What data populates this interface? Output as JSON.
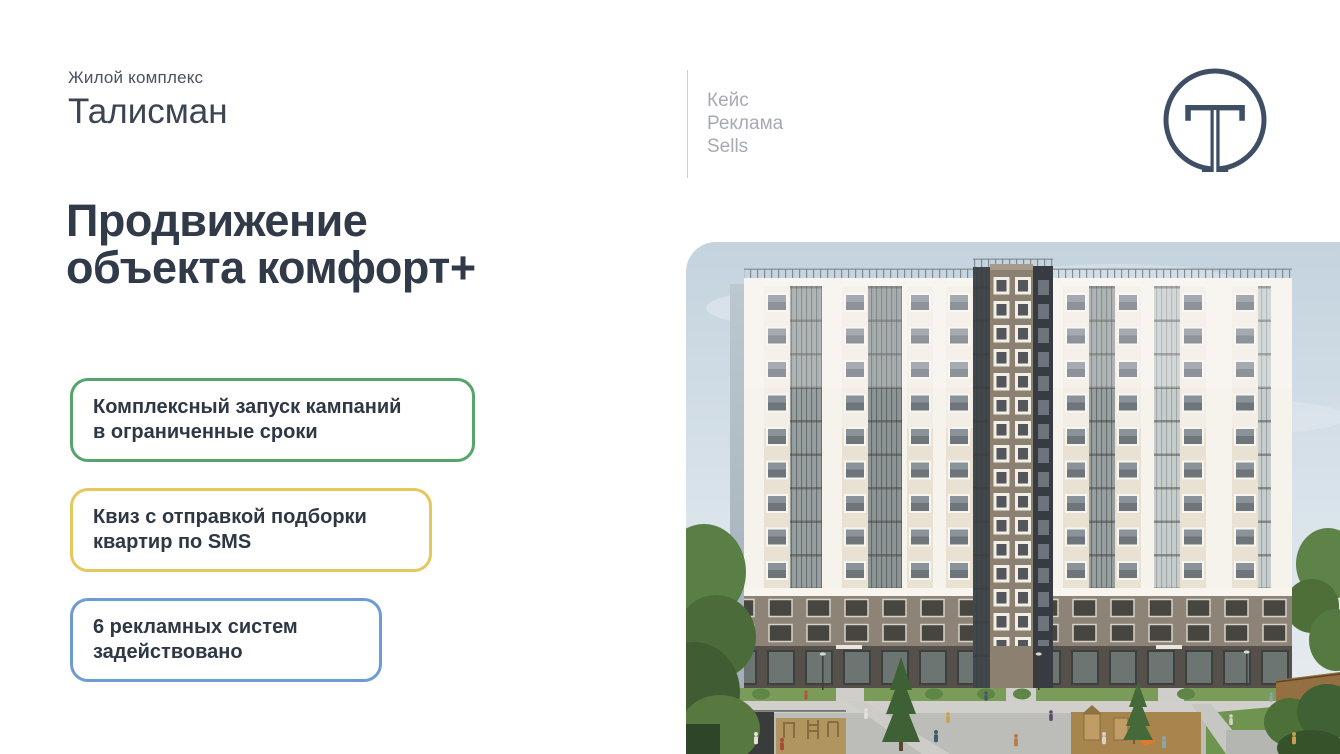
{
  "brand": {
    "label": "Жилой комплекс",
    "name": "Талисман"
  },
  "headline": "Продвижение\nобъекта комфорт+",
  "features": [
    {
      "text": "Комплексный запуск кампаний\nв ограниченные сроки",
      "border_color": "#57a46c"
    },
    {
      "text": "Квиз с отправкой подборки\nквартир по SMS",
      "border_color": "#e4c85e"
    },
    {
      "text": "6 рекламных систем\nзадействовано",
      "border_color": "#6d9bd4"
    }
  ],
  "case_labels": [
    "Кейс",
    "Реклама",
    "Sells"
  ],
  "logo": {
    "letter": "T",
    "color": "#3e4e65"
  },
  "colors": {
    "heading_text": "#313a48",
    "body_text": "#2e3744",
    "muted_text": "#a6aab4",
    "accent_green": "#57a46c",
    "accent_yellow": "#e4c85e",
    "accent_blue": "#6d9bd4",
    "logo_navy": "#3e4e65"
  },
  "hero_image": {
    "subject": "apartment-building-render"
  }
}
